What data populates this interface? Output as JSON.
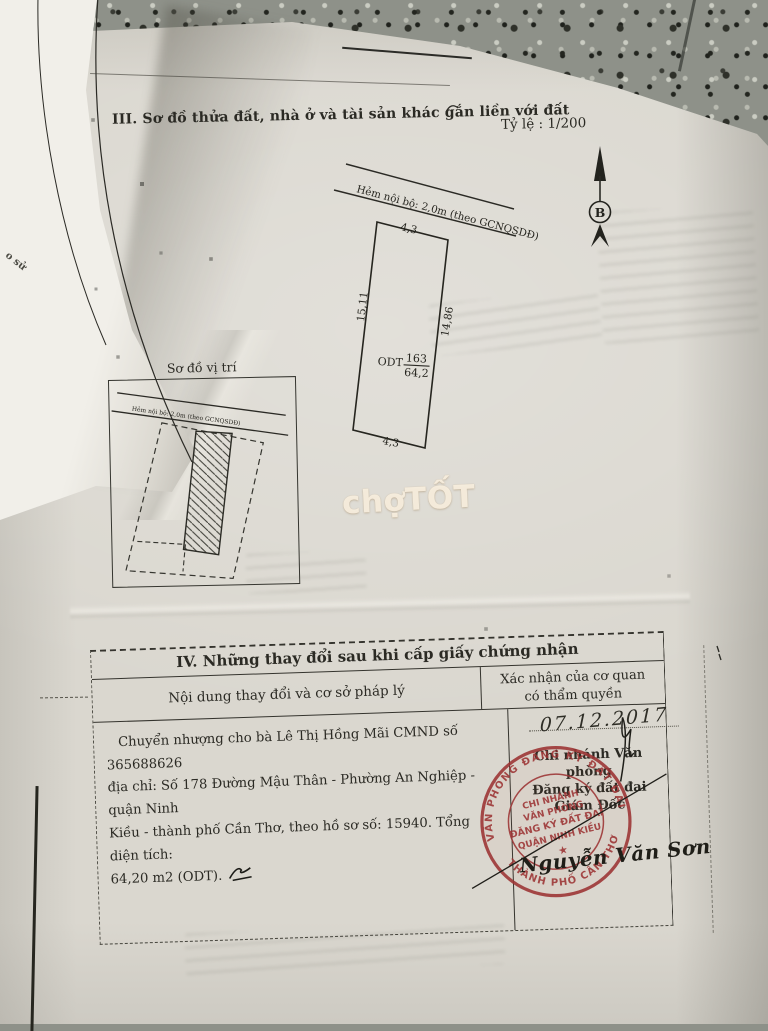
{
  "meta": {
    "paper_color": "#dad7cf",
    "stamp_color": "#9c3333",
    "granite_color": "#8e9189",
    "ink_color": "#26251f"
  },
  "fold": {
    "edge_text": "o sử"
  },
  "section3": {
    "title": "III. Sơ đồ thửa đất, nhà ở và tài sản khác gắn liền với đất",
    "scale_label": "Tỷ lệ : 1/200",
    "north_label": "B",
    "plot_diagram": {
      "alley_label": "Hẻm nội bộ: 2,0m (theo GCNQSDĐ)",
      "front_width": "4,3",
      "left_length": "15,11",
      "right_length": "14,86",
      "back_width": "4,3",
      "land_use": "ODT",
      "parcel_number": "163",
      "area": "64,2"
    },
    "location_diagram": {
      "title": "Sơ đồ vị trí",
      "alley_label": "Hẻm nội bộ: 2,0m (theo GCNQSDĐ)"
    }
  },
  "watermark": {
    "text": "chợTỐT"
  },
  "section4": {
    "title": "IV. Những thay đổi sau khi cấp giấy chứng nhận",
    "col_content": "Nội dung thay đổi và cơ sở pháp lý",
    "col_confirm_line1": "Xác nhận của cơ quan",
    "col_confirm_line2": "có thẩm quyền",
    "content_lines": [
      "Chuyển nhượng cho bà Lê Thị Hồng Mãi CMND số 365688626",
      "địa chỉ: Số 178 Đường Mậu Thân - Phường An Nghiệp - quận Ninh",
      "Kiều - thành phố Cần Thơ, theo hồ sơ số: 15940. Tổng diện tích:",
      "64,20 m2 (ODT)."
    ],
    "date": "07.12.2017",
    "office_lines": [
      "Chi nhánh Văn phòng",
      "Đăng ký đất đai",
      "Giám Đốc"
    ],
    "stamp": {
      "ring_top": "VĂN PHÒNG ĐĂNG KÝ ĐẤT ĐAI",
      "ring_bottom": "THÀNH PHỐ CẦN THƠ",
      "center_lines": [
        "CHI NHÁNH",
        "VĂN PHÒNG",
        "ĐĂNG KÝ ĐẤT ĐAI",
        "QUẬN NINH KIỀU"
      ],
      "star": "★"
    },
    "signature": "Nguyễn Văn Sơn"
  }
}
